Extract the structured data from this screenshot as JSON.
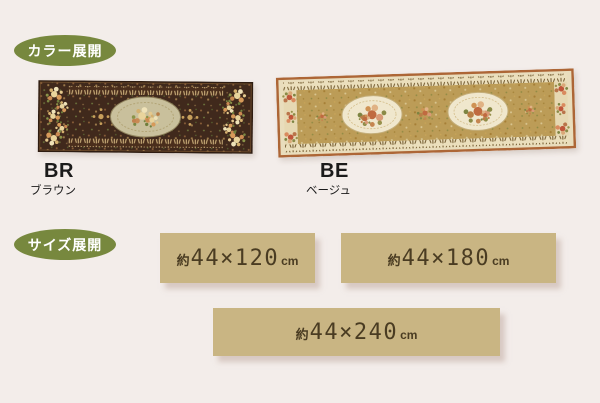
{
  "badges": {
    "color_section": "カラー展開",
    "size_section": "サイズ展開"
  },
  "colors": [
    {
      "code": "BR",
      "name": "ブラウン"
    },
    {
      "code": "BE",
      "name": "ベージュ"
    }
  ],
  "sizes": [
    {
      "approx": "約",
      "dims": "44×120",
      "unit": "cm"
    },
    {
      "approx": "約",
      "dims": "44×180",
      "unit": "cm"
    },
    {
      "approx": "約",
      "dims": "44×240",
      "unit": "cm"
    }
  ],
  "palette": {
    "page_bg": "#f3edea",
    "badge_green": "#77883e",
    "badge_text": "#ffffff",
    "size_box_tan": "#c9b583",
    "size_text_brown": "#4a3c22",
    "brown_rug_field": "#40291c",
    "beige_rug_field": "#bc9c57",
    "beige_rug_trim": "#ad6636"
  }
}
